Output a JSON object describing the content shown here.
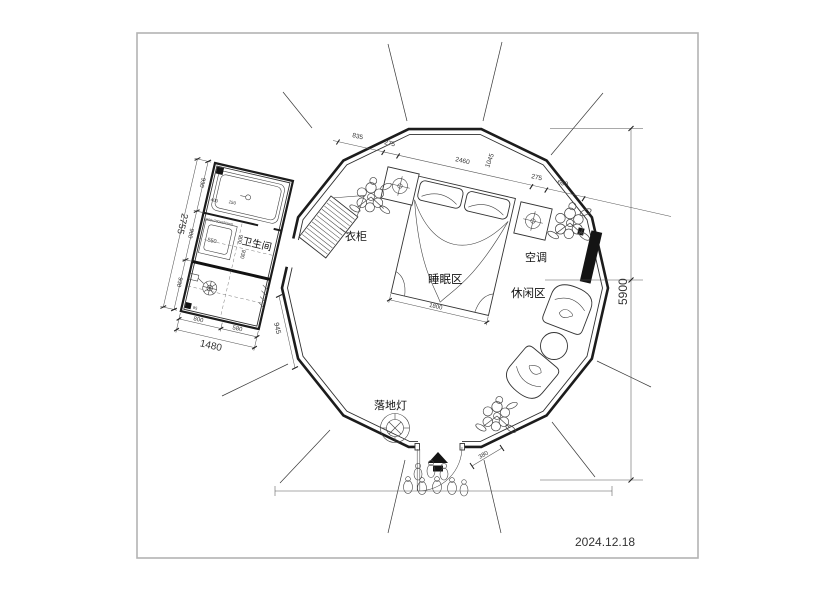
{
  "meta": {
    "date": "2024.12.18"
  },
  "labels": {
    "bathroom": "卫生间",
    "wardrobe": "衣柜",
    "sleeping_area": "睡眠区",
    "leisure_area": "休闲区",
    "air_conditioner": "空调",
    "floor_lamp": "落地灯"
  },
  "dims": {
    "front_chain": [
      "835",
      "275",
      "2460",
      "1045",
      "275",
      "690"
    ],
    "overall_height": "5900",
    "bed_width": "1800",
    "door_offset": "380",
    "bathroom": {
      "left_total": "2755",
      "left_segments": [
        "930",
        "900",
        "930"
      ],
      "bottom_segments": [
        "800",
        "580"
      ],
      "bottom_total": "1480",
      "side_gap": "945",
      "shower_tray": "550",
      "inner_a": "900",
      "inner_b": "930",
      "small_a": "400",
      "small_b": "150",
      "small_c": "95",
      "tub_note": "1500x700x650mm"
    }
  },
  "colors": {
    "line": "#2a2a2a",
    "frame": "#b3b3b3",
    "solid_fill": "#141414"
  }
}
